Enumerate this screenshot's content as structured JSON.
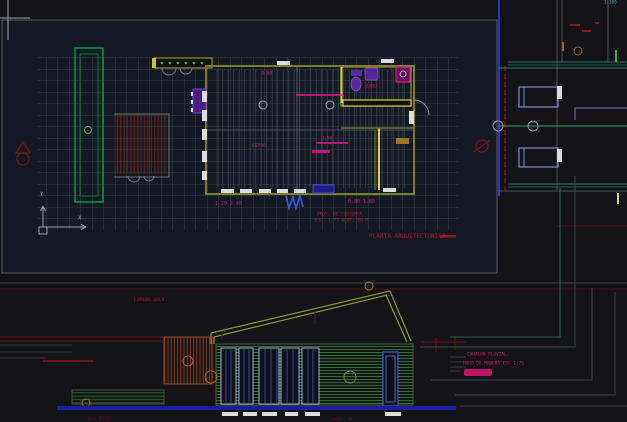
{
  "palette": {
    "background": "#131318",
    "viewport_fill": "#18202e",
    "grid_line": "#343e4a",
    "wall_olive": "#7d7d28",
    "wall_bright_yellow": "#d8d838",
    "site_green": "#00a050",
    "siding_green": "#2d7a2d",
    "magenta": "#e0188c",
    "annotation_red": "#a81828",
    "dark_red": "#5a1414",
    "wall_blue": "#2a35c0",
    "ground_blue": "#1c1c9e",
    "teal": "#1f7a6a",
    "room_cyan": "#7e8cc8",
    "fixture_purple": "#5a2a9e",
    "window_white": "#dcdcdc",
    "orange": "#a86024"
  },
  "icons": {
    "crosshair-icon": "+",
    "ucs-axes-icon": "L",
    "section-marker-icon": "^",
    "column-bubble-icon": "o"
  },
  "plan": {
    "title": "PLANTA ARQUITECTONICA",
    "room_label_1": "ESTAR",
    "room_label_2": "BAÑO",
    "dim_top": "0.60",
    "dim_mid": "1.50",
    "dims_left": "1.20  2.40",
    "dims_right": "0.90  1.80",
    "note_line_1": "PROY. DE CUBIERTA",
    "note_line_2": "ESC. 1:75  ACOT. EN M"
  },
  "elevation": {
    "note_left": "LAMINA GALV.",
    "note_right_1": "CANALON PLUVIAL",
    "note_right_2": "MURO DE MADERA  ESC 1:75"
  },
  "misc": {
    "corner_scale": "1:100",
    "bottom_note_1": "ESC 1:75",
    "bottom_note_2": "ACOT. M",
    "ucs_x": "X",
    "ucs_y": "Y"
  }
}
